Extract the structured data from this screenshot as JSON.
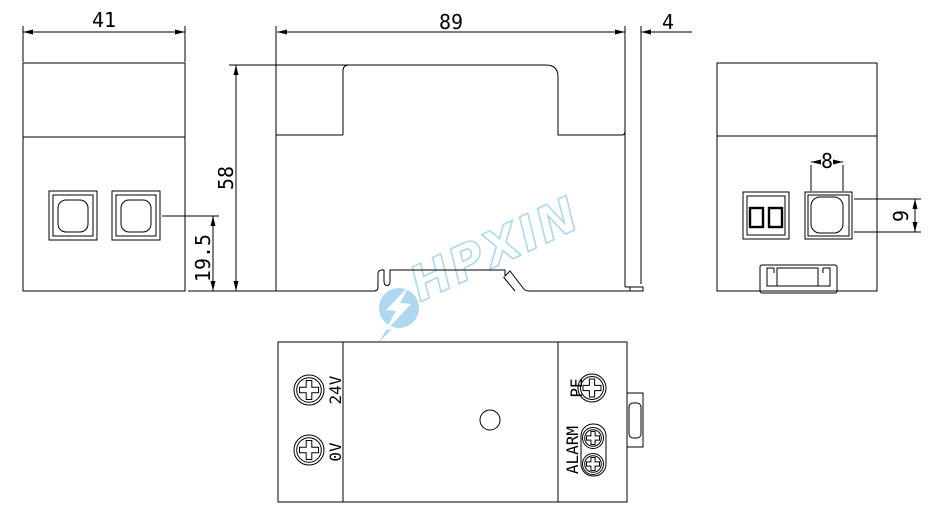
{
  "drawing": {
    "dims": {
      "left_width": "41",
      "body_width": "89",
      "end_plate": "4",
      "height": "58",
      "button_center": "19.5",
      "port_width": "8",
      "port_height": "9"
    },
    "terminals": {
      "v24": "24V",
      "v0": "0V",
      "pe": "PE",
      "alarm": "ALARM"
    },
    "watermark": "HPXIN",
    "colors": {
      "line": "#000000",
      "watermark": "#a9d6f0",
      "background": "#ffffff"
    }
  }
}
